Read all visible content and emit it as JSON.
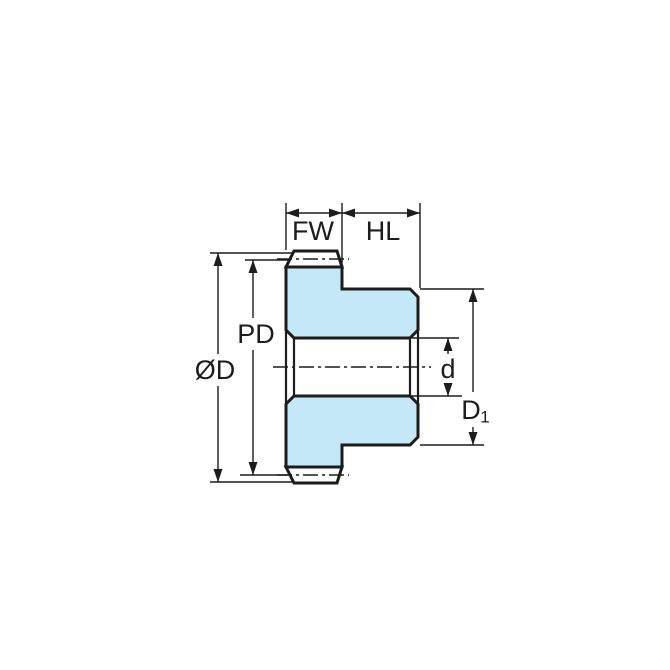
{
  "diagram": {
    "kind": "technical-drawing",
    "subject": "spur-gear-cross-section",
    "labels": {
      "face_width": "FW",
      "hub_length": "HL",
      "outside_diameter": "ØD",
      "pitch_diameter": "PD",
      "bore_diameter": "d",
      "hub_diameter_main": "D",
      "hub_diameter_sub": "1"
    },
    "colors": {
      "body_fill": "#c5e8f8",
      "line": "#1c1c1c",
      "background": "#ffffff"
    }
  }
}
